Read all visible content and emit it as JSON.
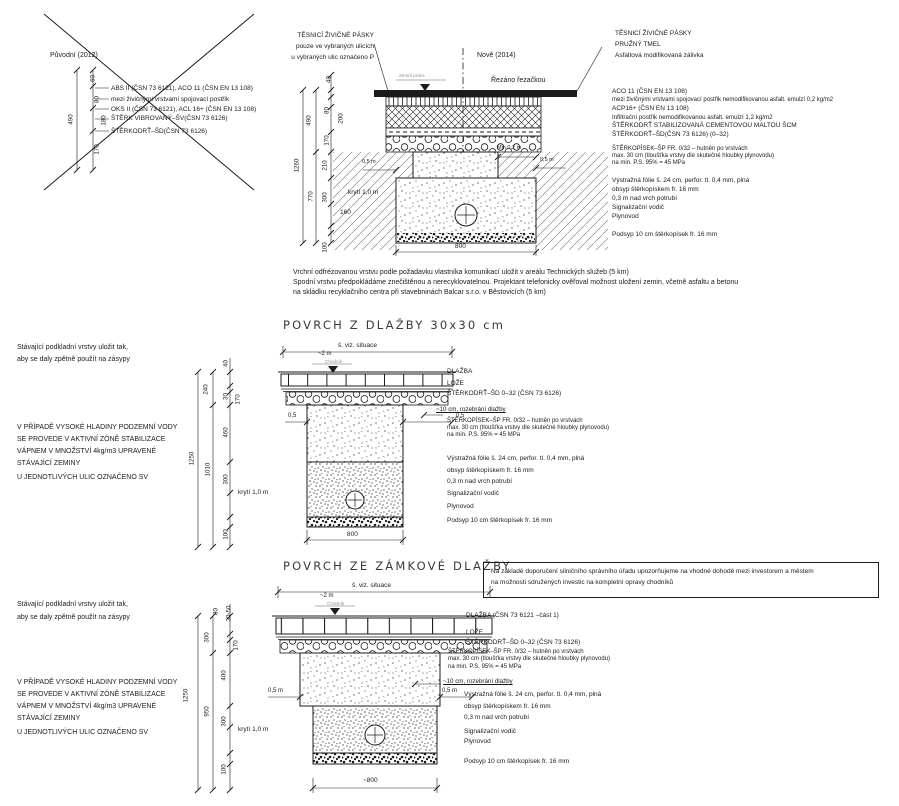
{
  "old_detail": {
    "title": "Původní (2012)",
    "lines": [
      "ABS II (ČSN 73 6121), ACO 11 (ČSN EN 13 108)",
      "mezi živičnými vrstvami spojovací postřik",
      "OKS II (ČSN 73 6121), ACL 16+ (ČSN EN 13 108)",
      "ŠTĚRK VIBROVANÝ–ŠV(ČSN 73 6126)",
      "ŠTĚRKODRŤ–ŠD(ČSN 73 6126)"
    ],
    "dims": {
      "d60": "60",
      "d490": "490",
      "d80": "80",
      "d180": "180",
      "d170": "170"
    }
  },
  "new_detail": {
    "title": "Nově (2014)",
    "tape_note": [
      "TĚSNICÍ ŽIVIČNÉ PÁSKY",
      "pouze ve vybraných ulicích",
      "u vybraných ulic označeno P"
    ],
    "cut_note": "Řezáno řezačkou",
    "level_note": "Zemní práce",
    "right_head": [
      "TĚSNICÍ ŽIVIČNÉ PÁSKY",
      "PRUŽNÝ TMEL",
      "Asfaltová modifikovaná zálivka"
    ],
    "labels": [
      "ACO 11 (ČSN EN 13 108)",
      "mezi živičnými vrstvami spojovací postřik nemodifikovanou asfalt. emulzí 0,2 kg/m2",
      "ACP16+ (ČSN EN 13 108)",
      "Infiltrační postřik nemodifikovanou asfalt. emulzí 1,2 kg/m2",
      "ŠTĚRKODRŤ STABILIZOVANÁ CEMENTOVOU MALTOU ŠCM",
      "ŠTĚRKODRŤ–ŠD(ČSN 73 6126) (0–32)",
      "ŠTĚRKOPÍSEK–ŠP FR. 0/32 – hutněn po vrstvách",
      "max. 30 cm (tloušťka vrstvy dle skutečné hloubky plynovodu)",
      "na min. P.S. 95% = 45 MPa",
      "Výstražná fólie š. 24 cm, perfor. tl. 0,4 mm, plná",
      "obsyp štěrkopískem fr. 16 mm",
      "0,3 m nad vrch potrubí",
      "Signalizační vodič",
      "Plynovod",
      "Podsyp 10 cm štěrkopísek fr. 16 mm"
    ],
    "dims": {
      "d40": "40",
      "d490": "490",
      "d80": "80",
      "d200": "200",
      "d170": "170",
      "d210": "210",
      "d300": "300",
      "d160": "160",
      "d770": "770",
      "d1260": "1260",
      "d100": "100",
      "kryti": "krytí 1,0 m",
      "l05": "0,5 m",
      "min02": "Min 0,2 m",
      "r05": "0,5 m",
      "w800": "800"
    }
  },
  "footnote": [
    "Vrchní odfrézovanou vrstvu podle požadavku vlastníka komunikací uložit v areálu Technických služeb (5 km)",
    "Spodní vrstvu předpokládáme znečištěnou a nerecyklovatelnou. Projektant telefonicky ověřoval možnost uložení zemin, včetně asfaltu a betonu",
    "na skládku recyklačního centra při stavebninách Balcar s.r.o. v Běstovicích (5 km)"
  ],
  "s2": {
    "title": "POVRCH Z DLAŽBY 30x30 cm",
    "reuse_note": [
      "Stávající podkladní vrstvy uložit tak,",
      "aby se daly zpětně použít na zásypy"
    ],
    "water_note": [
      "V PŘÍPADĚ VYSOKÉ HLADINY PODZEMNÍ VODY",
      "SE PROVEDE V AKTIVNÍ ZÓNĚ STABILIZACE",
      "VÁPNEM V MNOŽSTVÍ 4kg/m3 UPRAVENÉ",
      "STÁVAJÍCÍ ZEMINY"
    ],
    "sv_note": "U JEDNOTLIVÝCH ULIC OZNAČENO SV",
    "width_label": "š. viz. situace",
    "approx_width": "~2 m",
    "level_note": "Chodník",
    "labels": [
      "DLAŽBA",
      "LOŽE",
      "ŠTĚRKODRŤ–ŠD 0–32 (ČSN 73 6126)",
      "~10 cm, rozebrání dlažby",
      "ŠTĚRKOPÍSEK–ŠP FR. 0/32 – hutněn po vrstvách",
      "max. 30 cm (tloušťka vrstvy dle skutečné hloubky plynovodu)",
      "na min. P.S. 95% = 45 MPa",
      "Výstražná fólie š. 24 cm, perfor. tl. 0,4 mm, plná",
      "obsyp štěrkopískem fr. 16 mm",
      "0,3 m nad vrch potrubí",
      "Signalizační vodič",
      "Plynovod",
      "Podsyp 10 cm štěrkopísek fr. 16 mm"
    ],
    "dims": {
      "d40": "40",
      "d240": "240",
      "d30": "30",
      "d170": "170",
      "d460": "460",
      "d300": "300",
      "d1010": "1010",
      "d1250": "1250",
      "d100": "100",
      "kryti": "krytí 1,0 m",
      "l05": "0,5",
      "r05": "0,5",
      "w800": "800"
    }
  },
  "s3": {
    "title": "POVRCH ZE ZÁMKOVÉ DLAŽBY",
    "advice_box": [
      "Na základě doporučení silničního správního úřadu upozorňujeme na vhodné dohodě mezi investorem a městem",
      "na možnosti sdružených investic na kompletní opravy chodníků"
    ],
    "reuse_note": [
      "Stávající podkladní vrstvy uložit tak,",
      "aby se daly zpětně použít na zásypy"
    ],
    "water_note": [
      "V PŘÍPADĚ VYSOKÉ HLADINY PODZEMNÍ VODY",
      "SE PROVEDE V AKTIVNÍ ZÓNĚ STABILIZACE",
      "VÁPNEM V MNOŽSTVÍ 4kg/m3 UPRAVENÉ",
      "STÁVAJÍCÍ ZEMINY"
    ],
    "sv_note": "U JEDNOTLIVÝCH ULIC OZNAČENO SV",
    "width_label": "š. viz. situace",
    "approx_width": "~2 m",
    "level_note": "Chodník",
    "labels": [
      "DLAŽBA (ČSN 73 6121 –část 1)",
      "LOŽE",
      "ŠTĚRKODRŤ–ŠD 0–32 (ČSN 73 6126)",
      "ŠTĚRKOPÍSEK–ŠP FR. 0/32 – hutněn po vrstvách",
      "max. 30 cm (tloušťka vrstvy dle skutečné hloubky plynovodu)",
      "na min. P.S. 95% = 45 MPa",
      "~10 cm, rozebrání dlažby",
      "Výstražná fólie š. 24 cm, perfor. tl. 0,4 mm, plná",
      "obsyp štěrkopískem fr. 16 mm",
      "0,3 m nad vrch potrubí",
      "Signalizační vodič",
      "Plynovod",
      "Podsyp 10 cm štěrkopísek fr. 16 mm"
    ],
    "dims": {
      "d80": "80",
      "d3050": "30-50",
      "d300a": "300",
      "d170": "170",
      "d400": "400",
      "d950": "950",
      "d300b": "300",
      "d1250": "1250",
      "d100": "100",
      "kryti": "krytí 1,0 m",
      "l05": "0,5 m",
      "r05": "0,5 m",
      "w800": "~800"
    }
  }
}
